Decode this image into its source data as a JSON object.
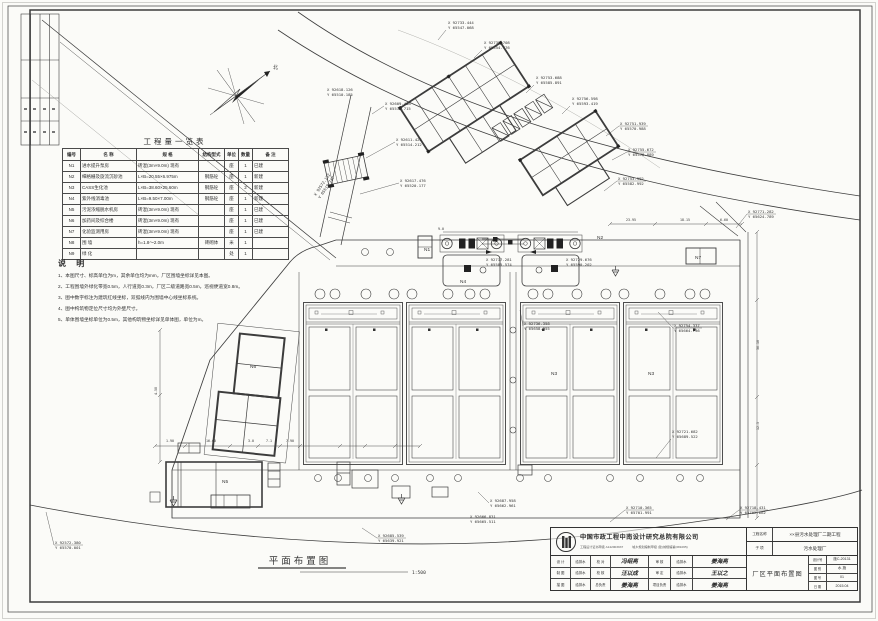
{
  "drawing_title": {
    "text": "平面布置图",
    "scale": "1:500"
  },
  "compass": {
    "north_label": "北"
  },
  "quantity_table": {
    "title": "工程量一览表",
    "headers": [
      "编号",
      "名  称",
      "规  格",
      "结构型式",
      "单位",
      "数量",
      "备  注"
    ],
    "rows": [
      [
        "N1",
        "进水提升泵房",
        "砖混(3m×9.0m) 现有",
        "",
        "座",
        "1",
        "已建"
      ],
      [
        "N2",
        "细格栅及旋流沉砂池",
        "L×B=20.55×6.975m",
        "钢筋砼",
        "座",
        "1",
        "新建"
      ],
      [
        "N3",
        "CASS生化池",
        "L×B=38.60×25.60m",
        "钢筋砼",
        "座",
        "2",
        "新建"
      ],
      [
        "N4",
        "紫外线消毒池",
        "L×B=9.50×7.00m",
        "钢筋砼",
        "座",
        "1",
        "新建"
      ],
      [
        "N5",
        "污泥浓缩脱水机房",
        "砖混(3m×9.0m) 现有",
        "",
        "座",
        "1",
        "已建"
      ],
      [
        "N6",
        "加药间及综合楼",
        "砖混(3m×9.0m) 现有",
        "",
        "座",
        "1",
        "已建"
      ],
      [
        "N7",
        "化验监测用房",
        "砖混(3m×9.0m) 现有",
        "",
        "座",
        "1",
        "已建"
      ],
      [
        "N8",
        "围  墙",
        "h=1.8～2.0m",
        "砖砌体",
        "米",
        "1",
        ""
      ],
      [
        "N9",
        "绿  化",
        "",
        "",
        "处",
        "1",
        ""
      ]
    ]
  },
  "notes": {
    "title": "说  明",
    "items": [
      "1、本图尺寸、标高单位为m，其余单位均为mm，厂区围墙坐标详见本图。",
      "2、工程围墙外绿化带宽0.5m，人行道宽0.3m，厂区二级道路宽0.5m，巡视便道宽0.8m。",
      "3、图中数字标注为建筑红线坐标，双弧线内为围墙中心线坐标系统。",
      "4、图中构筑物定位尺寸均为外壁尺寸。",
      "5、单体围墙坐标单位为0.5m，其他构筑物坐标详见单体图，单位为m。"
    ]
  },
  "coords": [
    {
      "x": "X 92733.444",
      "y": "Y 65547.068"
    },
    {
      "x": "X 92739.708",
      "y": "Y 65554.776"
    },
    {
      "x": "X 92753.688",
      "y": "Y 65585.891"
    },
    {
      "x": "X 92756.598",
      "y": "Y 65593.419"
    },
    {
      "x": "X 92751.939",
      "y": "Y 65570.988"
    },
    {
      "x": "X 92755.672",
      "y": "Y 65578.889"
    },
    {
      "x": "X 92753.992",
      "y": "Y 65582.992"
    },
    {
      "x": "X 92771.282",
      "y": "Y 65624.789"
    },
    {
      "x": "X 92618.126",
      "y": "Y 65510.185"
    },
    {
      "x": "X 92609.458",
      "y": "Y 65510.715"
    },
    {
      "x": "X 92611.426",
      "y": "Y 65514.212"
    },
    {
      "x": "X 92617.476",
      "y": "Y 65520.177"
    },
    {
      "x": "X 92717.281",
      "y": "Y 65585.574"
    },
    {
      "x": "X 92729.676",
      "y": "Y 65590.202"
    },
    {
      "x": "X 92736.358",
      "y": "Y 65658.955"
    },
    {
      "x": "X 92754.337",
      "y": "Y 65664.736"
    },
    {
      "x": "X 92721.682",
      "y": "Y 65689.522"
    },
    {
      "x": "X 92687.958",
      "y": "Y 65662.961"
    },
    {
      "x": "X 92666.831",
      "y": "Y 65665.511"
    },
    {
      "x": "X 92710.365",
      "y": "Y 65701.991"
    },
    {
      "x": "X 92718.431",
      "y": "Y 65702.662"
    },
    {
      "x": "X 92685.539",
      "y": "Y 65639.921"
    },
    {
      "x": "X 92572.380",
      "y": "Y 65570.001"
    },
    {
      "x": "X 92572.132",
      "y": "Y 65519.717"
    }
  ],
  "dims": [
    "1.90",
    "16.60",
    "3.0",
    "7.1",
    "7.90",
    "23.95",
    "18.15",
    "6.60",
    "36.10",
    "12.5",
    "4.50",
    "9.0"
  ],
  "labels": {
    "n1": "N1",
    "n2": "N2",
    "n3a": "N3",
    "n3b": "N3",
    "n4": "N4",
    "n5": "N5",
    "n6": "N6",
    "n7": "N7"
  },
  "title_block": {
    "company": "中国市政工程中南设计研究总院有限公司",
    "cert_left": "工程设计证书甲级 A142003937",
    "cert_right": "城乡规划编制甲级 (建)城规编第(081065)",
    "project_label": "工程名称",
    "project_value": "××县污水处理厂二期工程",
    "sub_label": "子  项",
    "sub_value": "污水处理厂",
    "drawing_name": "厂区平面布置图",
    "fields": [
      {
        "label": "设计号",
        "value": "施C-20131"
      },
      {
        "label": "图 别",
        "value": "水 施"
      },
      {
        "label": "图 号",
        "value": "01"
      },
      {
        "label": "日 期",
        "value": "2015.04"
      }
    ],
    "sig_rows": [
      [
        "设 计",
        "给排水",
        "校 对",
        "冯绍亮",
        "审 核",
        "给排水",
        "姜海亮"
      ],
      [
        "制 图",
        "给排水",
        "校 核",
        "汪以成",
        "审 定",
        "给排水",
        "王以之"
      ],
      [
        "描 图",
        "给排水",
        "总负责",
        "姜海亮",
        "项目负责",
        "给排水",
        "姜海亮"
      ]
    ]
  }
}
